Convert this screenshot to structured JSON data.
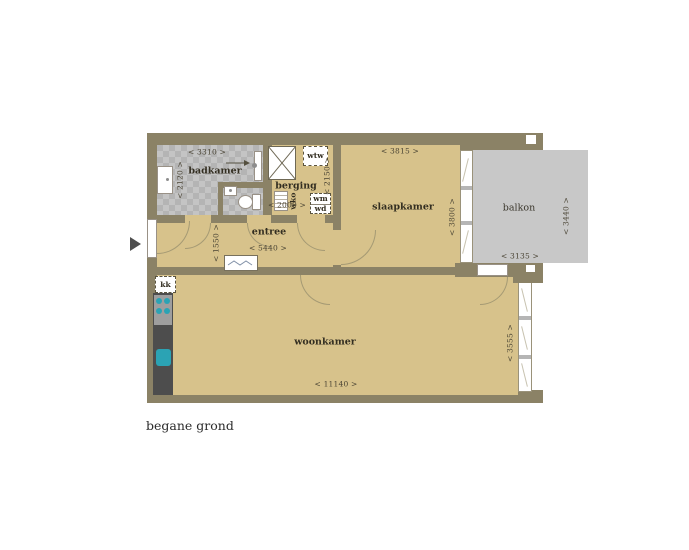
{
  "title": "begane grond",
  "rooms": {
    "badkamer": {
      "label": "badkamer",
      "width_label": "< 3310 >",
      "depth_label": "< 2120 >"
    },
    "berging": {
      "label": "berging",
      "width_label": "< 2000 >",
      "depth_label": "< 2150 >"
    },
    "entree": {
      "label": "entree",
      "width_label": "< 5440 >",
      "depth_label": "< 1550 >"
    },
    "slaapkamer": {
      "label": "slaapkamer",
      "width_label": "< 3815 >",
      "depth_label": "< 3800 >"
    },
    "balkon": {
      "label": "balkon",
      "width_label": "< 3135 >",
      "depth_label": "< 3440 >"
    },
    "woonkamer": {
      "label": "woonkamer",
      "width_label": "< 11140 >",
      "depth_label": "< 3555 >"
    }
  },
  "fixtures": {
    "kitchenette_label": "kk",
    "heat_recovery_label": "wtw",
    "wko_label": "wko",
    "washer_label": "wm",
    "dryer_label": "wd"
  },
  "colors": {
    "floor": "#d7c28b",
    "wall": "#8b8266",
    "tile_light": "#c4c4c4",
    "tile_dark": "#b4b4b4",
    "balcony": "#c8c8c8",
    "accent_teal": "#2ba3b4"
  }
}
